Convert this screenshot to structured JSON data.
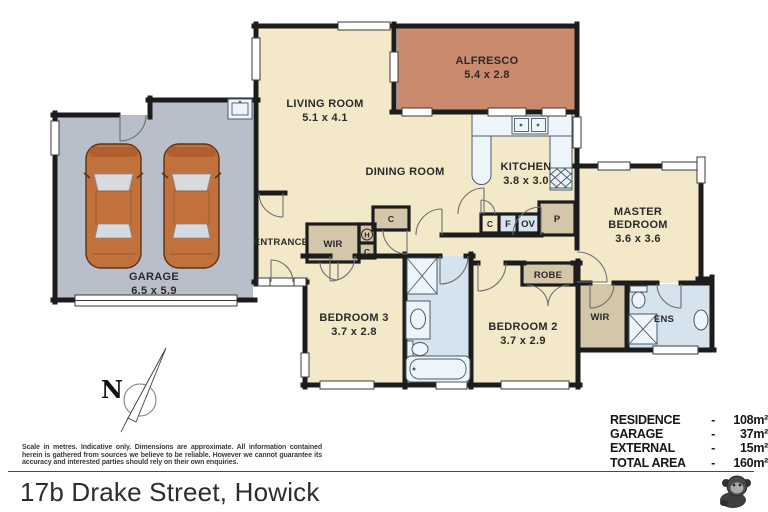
{
  "plan": {
    "rooms": {
      "alfresco": {
        "label": "ALFRESCO",
        "dims": "5.4 x 2.8"
      },
      "living_room": {
        "label": "LIVING ROOM",
        "dims": "5.1 x 4.1"
      },
      "dining_room": {
        "label": "DINING ROOM"
      },
      "kitchen": {
        "label": "KITCHEN",
        "dims": "3.8 x 3.0"
      },
      "master_bedroom": {
        "label_line1": "MASTER",
        "label_line2": "BEDROOM",
        "dims": "3.6 x 3.6"
      },
      "garage": {
        "label": "GARAGE",
        "dims": "6.5 x 5.9"
      },
      "entrance": {
        "label": "ENTRANCE"
      },
      "bedroom3": {
        "label": "BEDROOM 3",
        "dims": "3.7 x 2.8"
      },
      "bedroom2": {
        "label": "BEDROOM 2",
        "dims": "3.7 x 2.9"
      },
      "hall_wir": {
        "label": "WIR"
      },
      "master_wir": {
        "label": "WIR"
      },
      "robe": {
        "label": "ROBE"
      },
      "ensuite": {
        "label": "ENS"
      }
    },
    "fixtures": {
      "cupboard_top": "C",
      "hot_water": "H",
      "cold_cupboard": "C",
      "cupboard_small": "C",
      "fridge": "F",
      "oven": "OV",
      "pantry": "P"
    },
    "compass_label": "N"
  },
  "areas": {
    "rows": [
      {
        "label": "RESIDENCE",
        "sep": "-",
        "value": "108m²"
      },
      {
        "label": "GARAGE",
        "sep": "-",
        "value": "37m²"
      },
      {
        "label": "EXTERNAL",
        "sep": "-",
        "value": "15m²"
      },
      {
        "label": "TOTAL AREA",
        "sep": "-",
        "value": "160m²"
      }
    ]
  },
  "footer": {
    "disclaimer": "Scale in metres. Indicative only. Dimensions are approximate. All information contained herein is gathered from sources we believe to be reliable. However we cannot guarantee its accuracy and interested parties should rely on their own enquiries.",
    "address": "17b Drake Street, Howick"
  },
  "colors": {
    "wall": "#1c1c1c",
    "room_cream": "#f3e9c9",
    "garage_grey": "#b9bfca",
    "alfresco_terracotta": "#c98a6d",
    "wet_blue": "#d5e3ee",
    "closet_tan": "#d4c6a8",
    "car_orange": "#c0713c"
  }
}
